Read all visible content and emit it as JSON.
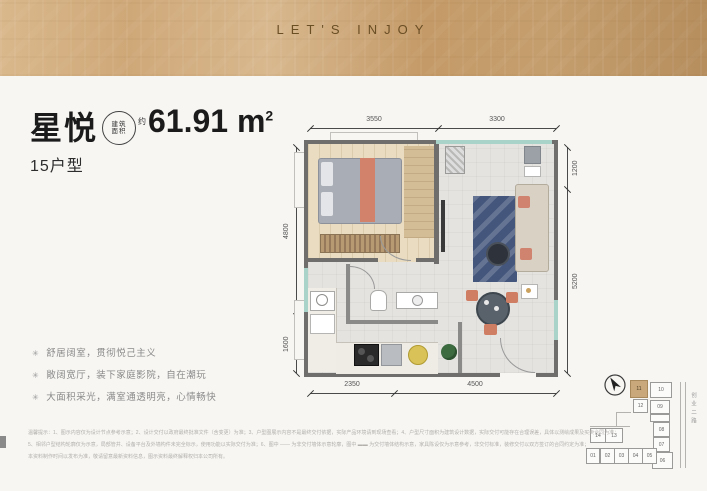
{
  "header": {
    "brand_text": "LET'S INJOY"
  },
  "unit": {
    "name": "星悦",
    "area_badge": {
      "line1": "建筑",
      "line2": "面积",
      "approx": "约"
    },
    "area_value": "61.91 m",
    "area_exponent": "2",
    "type_label": "15户型"
  },
  "features": {
    "bullet_glyph": "✳",
    "items": [
      "舒居阔室，贯彻悦己主义",
      "敞阔宽厅，装下家庭影院，自在潮玩",
      "大面积采光，满室通透明亮，心情畅快"
    ]
  },
  "floorplan": {
    "dimensions": {
      "top": [
        "3550",
        "3300"
      ],
      "left": [
        "4800",
        "1600"
      ],
      "right": [
        "1200",
        "5200"
      ],
      "bottom": [
        "2350",
        "4500"
      ]
    }
  },
  "keyplan": {
    "road_label": "创业二路",
    "units": [
      {
        "label": "11",
        "highlight": true
      },
      {
        "label": "10"
      },
      {
        "label": "12"
      },
      {
        "label": "09"
      },
      {
        "label": "08"
      },
      {
        "label": "07"
      },
      {
        "label": "06"
      },
      {
        "label": "14"
      },
      {
        "label": "13"
      },
      {
        "label": "01"
      },
      {
        "label": "02"
      },
      {
        "label": "03"
      },
      {
        "label": "04"
      },
      {
        "label": "05"
      }
    ]
  },
  "disclaimer": {
    "lines": [
      "温馨提示：1、图示内容仅为设计节点参考示意；2、设计交付以政府最终批准文件（含变更）为准；3、户型图展示内容不是最终交付依据，实际产品环境请到现场查看；4、户型尺寸面积为建筑设计数据，实际交付可能存在合理误差，具体以测绘成果及买卖合同为准；",
      "5、相邻户型结构轮廓仅为示意，局部管井、设备平台及外墙构件未完全标示，使用功能以实际交付为准；6、图中 —— 为非交付墙体示意轮廓，图中 ▬▬ 为交付墙体结构示意，家具陈设仅为示意参考，非交付标准，装修交付以双方签订的合同约定为准；",
      "本资料制作时间以发布为准，敬请留意最新资料信息，图示资料最终解释权归本公司所有。"
    ]
  },
  "colors": {
    "band_gold": "#c8a271",
    "highlight_tan": "#c9a87c",
    "furniture_salmon": "#d0836e",
    "rug_navy": "#44567c",
    "window_teal": "#a9d3c9"
  }
}
